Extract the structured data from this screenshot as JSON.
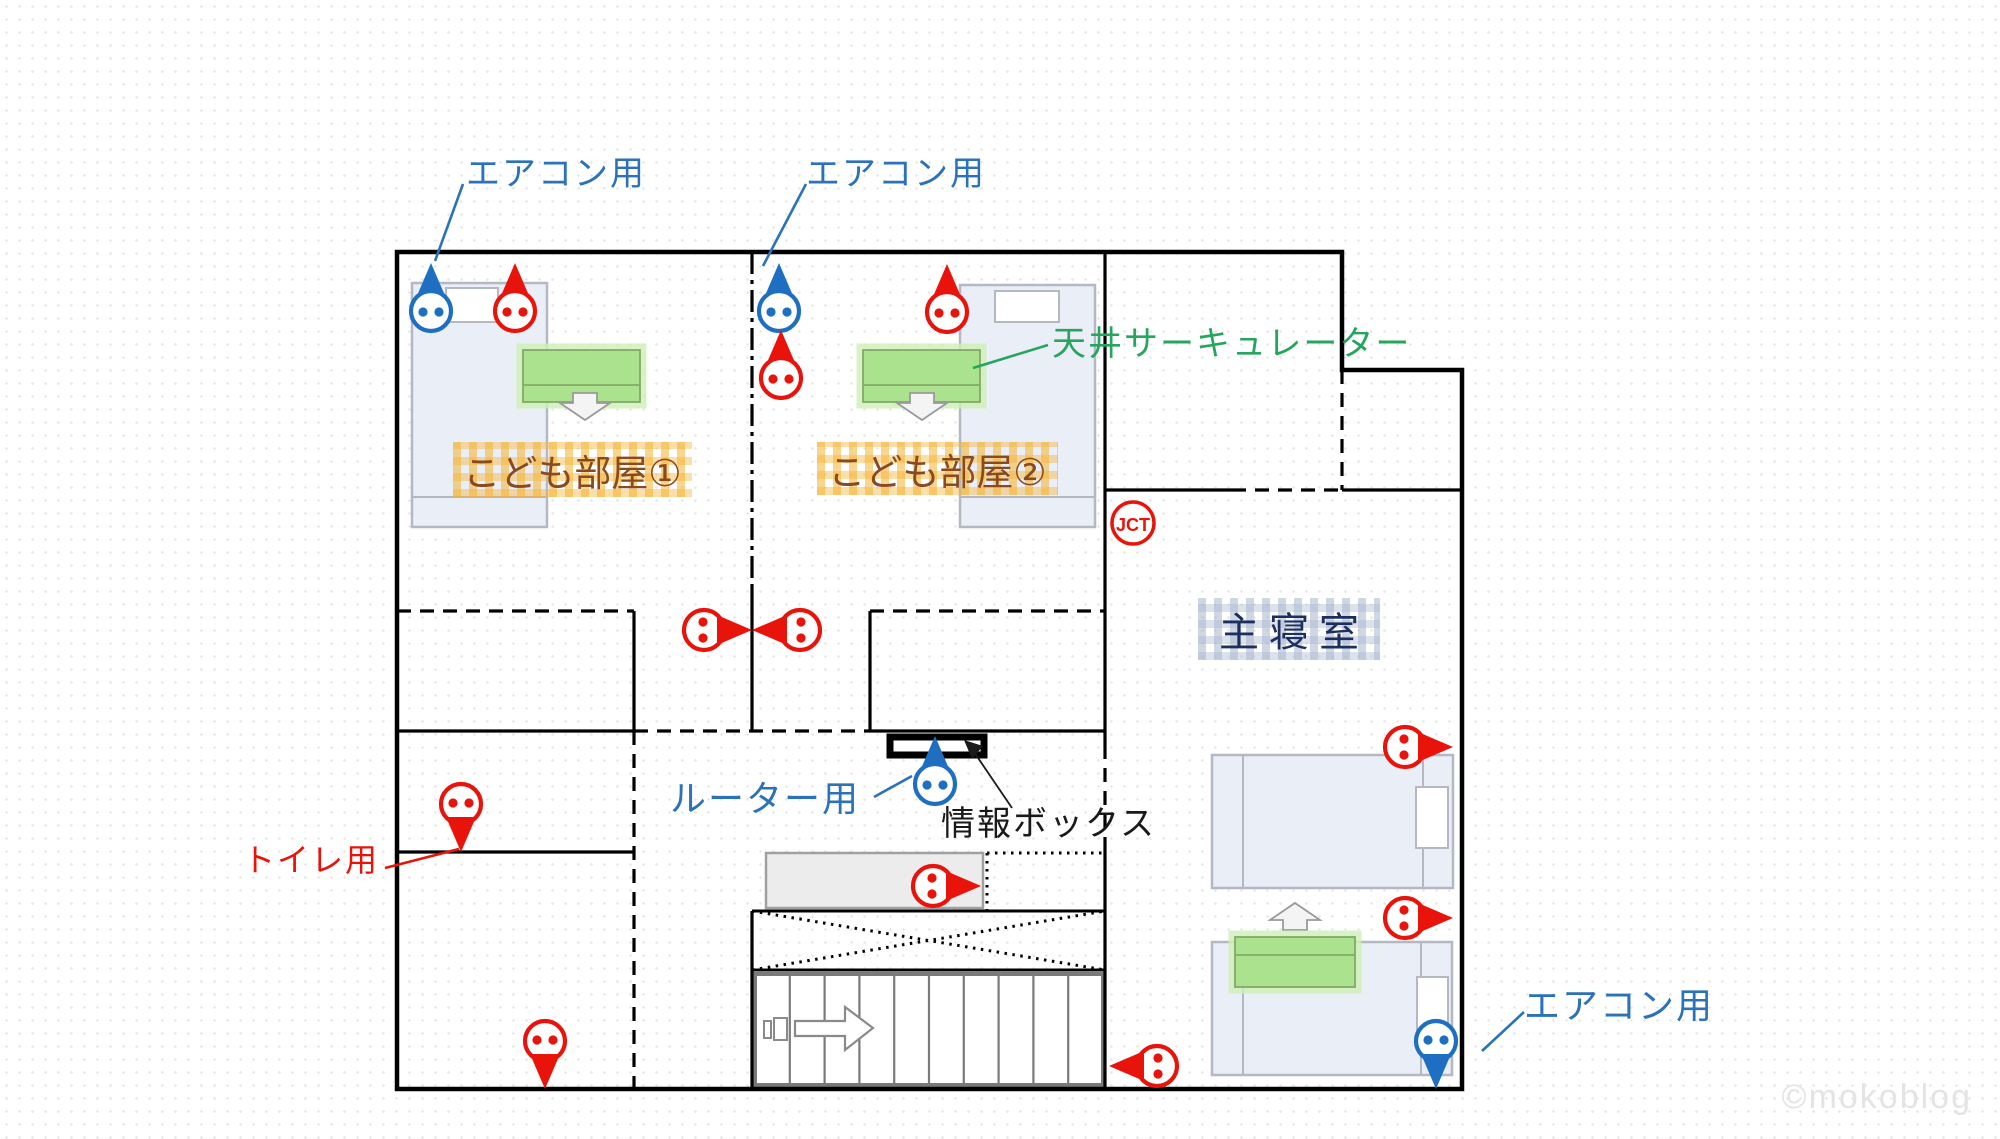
{
  "title": "2F electrical outlet floor plan",
  "watermark": "©mokoblog",
  "colors": {
    "outlet": {
      "red": "#e8140c",
      "blue": "#1e6ec2"
    },
    "label_blue": "#2b72b8",
    "label_green": "#27a55f",
    "label_red": "#e8140c",
    "wall": "#000000",
    "desk_green": "#abe28e",
    "bed_fill": "#eaeef6"
  },
  "labels": {
    "aircon_kids1": "エアコン用",
    "aircon_kids2": "エアコン用",
    "aircon_master": "エアコン用",
    "ceiling_circulator": "天井サーキュレーター",
    "router": "ルーター用",
    "info_box": "情報ボックス",
    "toilet": "トイレ用",
    "junction": "JCT"
  },
  "rooms": {
    "kids_room_1": "こども部屋①",
    "kids_room_2": "こども部屋②",
    "master_bedroom": "主寝室"
  },
  "outlets": [
    {
      "id": "kids1-aircon",
      "color": "blue",
      "purpose": "エアコン用",
      "x": 431,
      "y": 311,
      "dir": "up"
    },
    {
      "id": "kids1-wall",
      "color": "red",
      "purpose": "コンセント",
      "x": 515,
      "y": 311,
      "dir": "up"
    },
    {
      "id": "kids2-aircon",
      "color": "blue",
      "purpose": "エアコン用",
      "x": 779,
      "y": 311,
      "dir": "up"
    },
    {
      "id": "kids2-wall-a",
      "color": "red",
      "purpose": "コンセント",
      "x": 781,
      "y": 378,
      "dir": "up"
    },
    {
      "id": "kids2-wall-b",
      "color": "red",
      "purpose": "コンセント",
      "x": 947,
      "y": 312,
      "dir": "up"
    },
    {
      "id": "kids1-partition",
      "color": "red",
      "purpose": "コンセント",
      "x": 704,
      "y": 630,
      "dir": "right"
    },
    {
      "id": "kids2-partition",
      "color": "red",
      "purpose": "コンセント",
      "x": 800,
      "y": 630,
      "dir": "left"
    },
    {
      "id": "toilet",
      "color": "red",
      "purpose": "トイレ用",
      "x": 461,
      "y": 804,
      "dir": "down"
    },
    {
      "id": "washroom",
      "color": "red",
      "purpose": "コンセント",
      "x": 545,
      "y": 1041,
      "dir": "down"
    },
    {
      "id": "router",
      "color": "blue",
      "purpose": "ルーター用",
      "x": 935,
      "y": 784,
      "dir": "up"
    },
    {
      "id": "counter",
      "color": "red",
      "purpose": "コンセント",
      "x": 933,
      "y": 886,
      "dir": "right"
    },
    {
      "id": "hall",
      "color": "red",
      "purpose": "コンセント",
      "x": 1157,
      "y": 1066,
      "dir": "left"
    },
    {
      "id": "master-wall-a",
      "color": "red",
      "purpose": "コンセント",
      "x": 1405,
      "y": 747,
      "dir": "right"
    },
    {
      "id": "master-wall-b",
      "color": "red",
      "purpose": "コンセント",
      "x": 1405,
      "y": 918,
      "dir": "right"
    },
    {
      "id": "master-aircon",
      "color": "blue",
      "purpose": "エアコン用",
      "x": 1436,
      "y": 1041,
      "dir": "down"
    }
  ]
}
